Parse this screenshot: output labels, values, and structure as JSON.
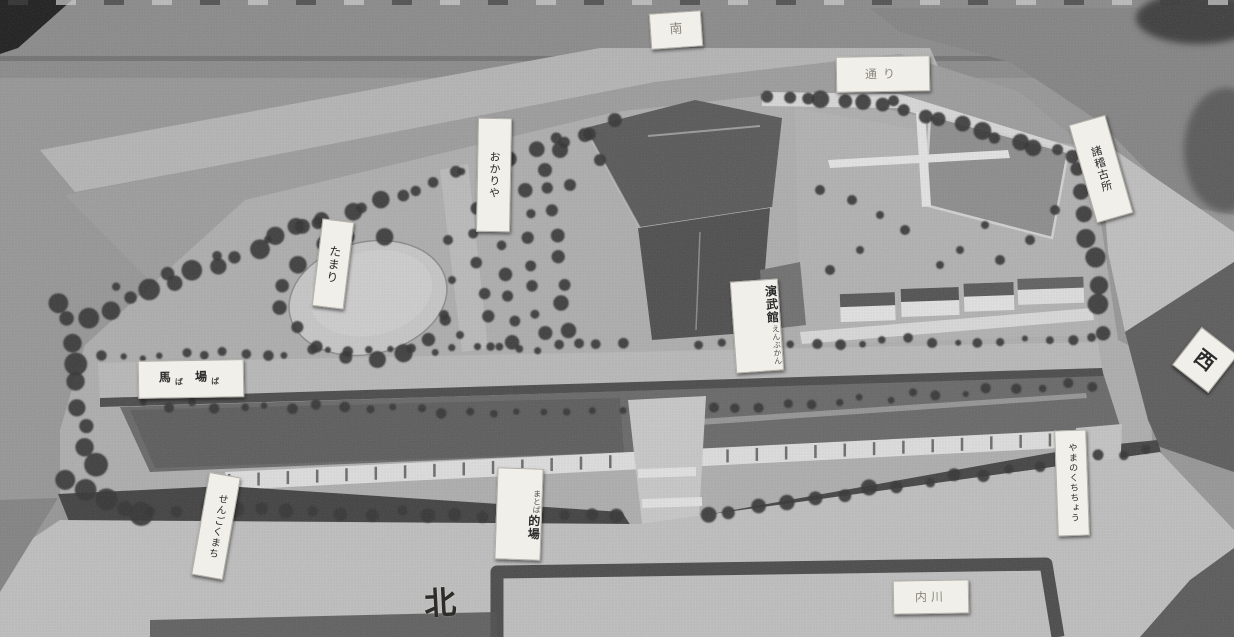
{
  "compass": {
    "north": "北",
    "west": "西",
    "south": "南"
  },
  "labels": {
    "rear_road": "通り",
    "okariya": "おかりや",
    "tamari": "たまり",
    "baba": {
      "kanji1": "馬",
      "kana1": "ば",
      "kanji2": "場",
      "kana2": "ば"
    },
    "enbukan": {
      "main": "演武館",
      "furigana": "えんぶかん"
    },
    "matoba": {
      "main": "的場",
      "furigana": "まとば"
    },
    "sengoku_machi": "せんごくまち",
    "keikosho": "諸稽古所",
    "yamanokuchi_cho": "やまのくちちょう",
    "uchikawa": "内川"
  },
  "colors": {
    "paper_label": "#f0efe9",
    "dark_foliage": "#333333",
    "board_light": "#c4c4c4",
    "roof_dark": "#505050"
  }
}
